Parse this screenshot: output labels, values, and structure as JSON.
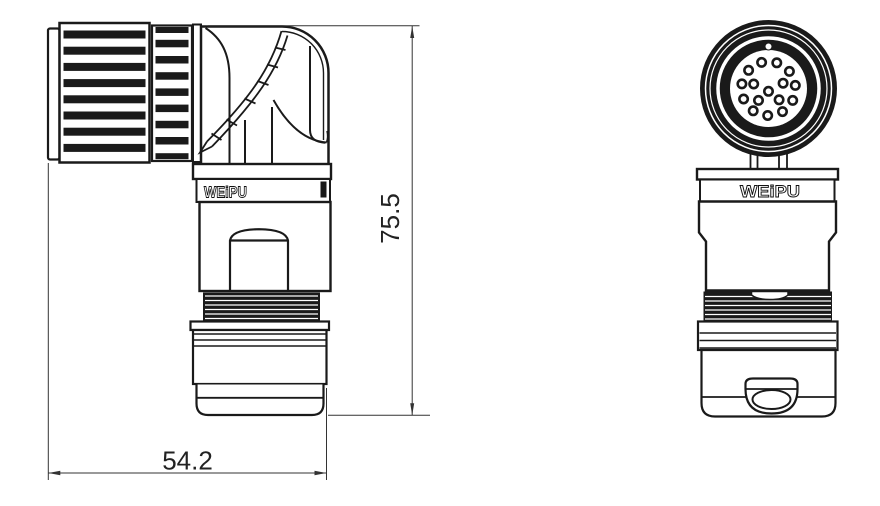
{
  "brand_label": "WEiPU",
  "views": {
    "side": {
      "logo": "WEiPU"
    },
    "front": {
      "logo": "WEiPU",
      "pin_count": 16
    }
  },
  "dimensions": {
    "height_mm": "75.5",
    "width_mm": "54.2"
  },
  "style": {
    "line_color": "#1a1a1a",
    "background": "#ffffff"
  }
}
